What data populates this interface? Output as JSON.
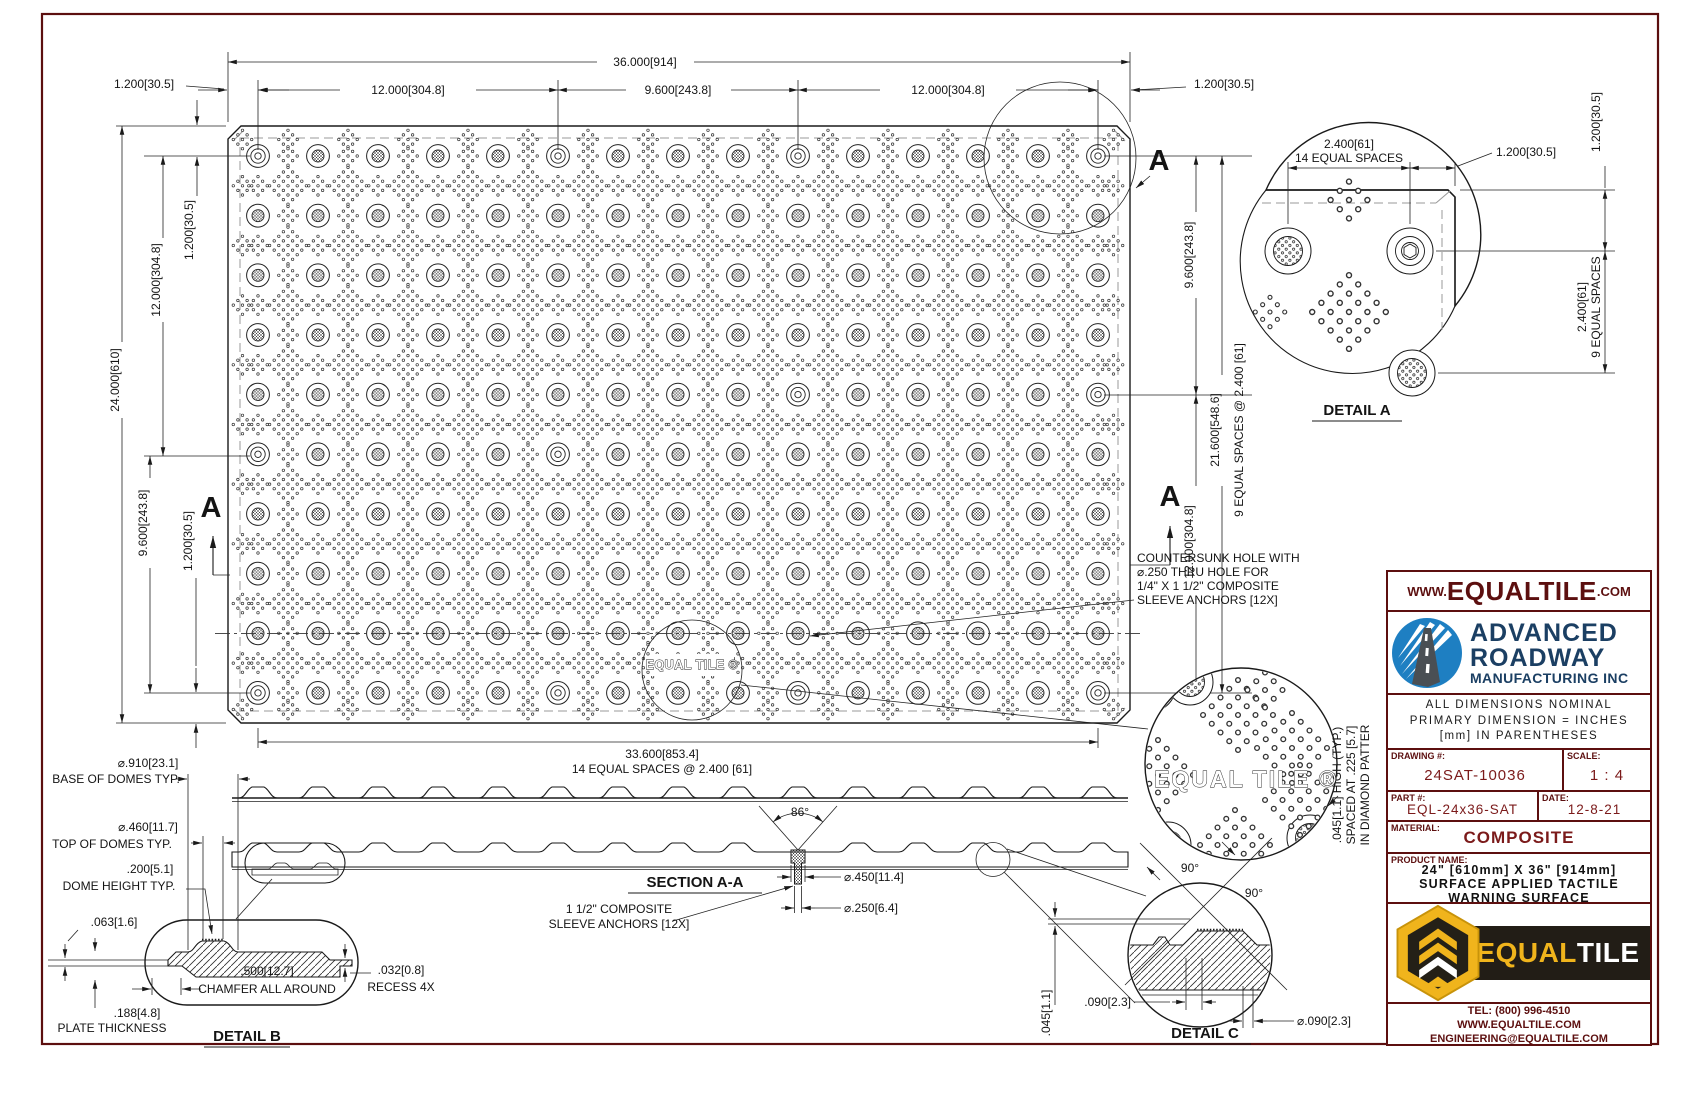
{
  "plan": {
    "dim_overall_w": "36.000[914]",
    "dim_margin_tl": "1.200[30.5]",
    "dim_span12_t1": "12.000[304.8]",
    "dim_span96_t": "9.600[243.8]",
    "dim_span12_t2": "12.000[304.8]",
    "dim_margin_tr": "1.200[30.5]",
    "dim_overall_h": "24.000[610]",
    "dim_span12_l": "12.000[304.8]",
    "dim_margin_lt": "1.200[30.5]",
    "dim_span96_l": "9.600[243.8]",
    "dim_margin_lb": "1.200[30.5]",
    "dim_span96_r": "9.600[243.8]",
    "dim_span216_r": "21.600[548.6]",
    "dim_spaces9_r": "9 EQUAL SPACES @ 2.400 [61]",
    "dim_span12_r": "12.000[304.8]",
    "dim_bottom": "33.600[853.4]",
    "dim_bottom_spaces": "14 EQUAL SPACES @ 2.400 [61]",
    "section_letter": "A",
    "tile_mark": "EQUAL TILE ®"
  },
  "note_countersunk": {
    "l1": "COUNTERSUNK HOLE WITH",
    "l2": "⌀.250 THRU HOLE FOR",
    "l3": "1/4\" X 1 1/2\" COMPOSITE",
    "l4": "SLEEVE ANCHORS [12X]"
  },
  "detail_a": {
    "title": "DETAIL A",
    "dim_h1": "2.400[61]",
    "dim_h2": "14 EQUAL SPACES",
    "dim_tr": "1.200[30.5]",
    "dim_r1": "1.200[30.5]",
    "dim_v1": "2.400[61]",
    "dim_v2": "9 EQUAL SPACES"
  },
  "section_aa": {
    "title": "SECTION A-A",
    "angle": "86°",
    "dia_csk": "⌀.450[11.4]",
    "dia_thru": "⌀.250[6.4]",
    "note1": "1 1/2\" COMPOSITE",
    "note2": "SLEEVE ANCHORS [12X]"
  },
  "detail_b": {
    "title": "DETAIL B",
    "base_dia": "⌀.910[23.1]",
    "base_lbl": "BASE OF DOMES TYP.",
    "top_dia": "⌀.460[11.7]",
    "top_lbl": "TOP OF DOMES TYP.",
    "height": ".200[5.1]",
    "height_lbl": "DOME HEIGHT TYP.",
    "lip": ".063[1.6]",
    "chamfer": ".500[12.7]",
    "chamfer_lbl": "CHAMFER ALL AROUND",
    "recess": ".032[0.8]",
    "recess_lbl": "RECESS 4X",
    "plate": ".188[4.8]",
    "plate_lbl": "PLATE THICKNESS"
  },
  "detail_c": {
    "title": "DETAIL C",
    "angle1": "90°",
    "angle2": "90°",
    "dim_w": ".090[2.3]",
    "dim_h": ".045[1.1]",
    "dim_dia": "⌀.090[2.3]"
  },
  "micro_note": {
    "l1": ".045[1.1] HIGH (TYP.)",
    "l2": "SPACED AT .225 [5.7]",
    "l3": "IN DIAMOND PATTER"
  },
  "magnifier": {
    "tile_mark": "EQUAL TILE ®"
  },
  "title_block": {
    "web_prefix": "WWW.",
    "web_name": "EQUALTILE",
    "web_suffix": ".COM",
    "company_line1": "ADVANCED",
    "company_line2": "ROADWAY",
    "company_line3": "MANUFACTURING INC",
    "dim_note_line1": "ALL DIMENSIONS NOMINAL",
    "dim_note_line2": "PRIMARY DIMENSION = INCHES",
    "dim_note_line3": "[mm] IN PARENTHESES",
    "drawing_no_label": "DRAWING #:",
    "drawing_no": "24SAT-10036",
    "scale_label": "SCALE:",
    "scale": "1 : 4",
    "part_no_label": "PART #:",
    "part_no": "EQL-24x36-SAT",
    "date_label": "DATE:",
    "date": "12-8-21",
    "material_label": "MATERIAL:",
    "material": "COMPOSITE",
    "product_name_label": "PRODUCT NAME:",
    "product_line1": "24\" [610mm] X 36\" [914mm]",
    "product_line2": "SURFACE APPLIED TACTILE",
    "product_line3": "WARNING SURFACE",
    "logo_equal": "EQUAL",
    "logo_tile": "TILE",
    "tel": "TEL: (800) 996-4510",
    "web": "WWW.EQUALTILE.COM",
    "email": "ENGINEERING@EQUALTILE.COM"
  },
  "colors": {
    "accent_maroon": "#5C0F0F",
    "value_maroon": "#7B1A1A",
    "company_blue": "#1B3F63",
    "logo_blue": "#1E7FC2",
    "brand_yellow": "#F0B41C",
    "banner_black": "#221D16"
  }
}
